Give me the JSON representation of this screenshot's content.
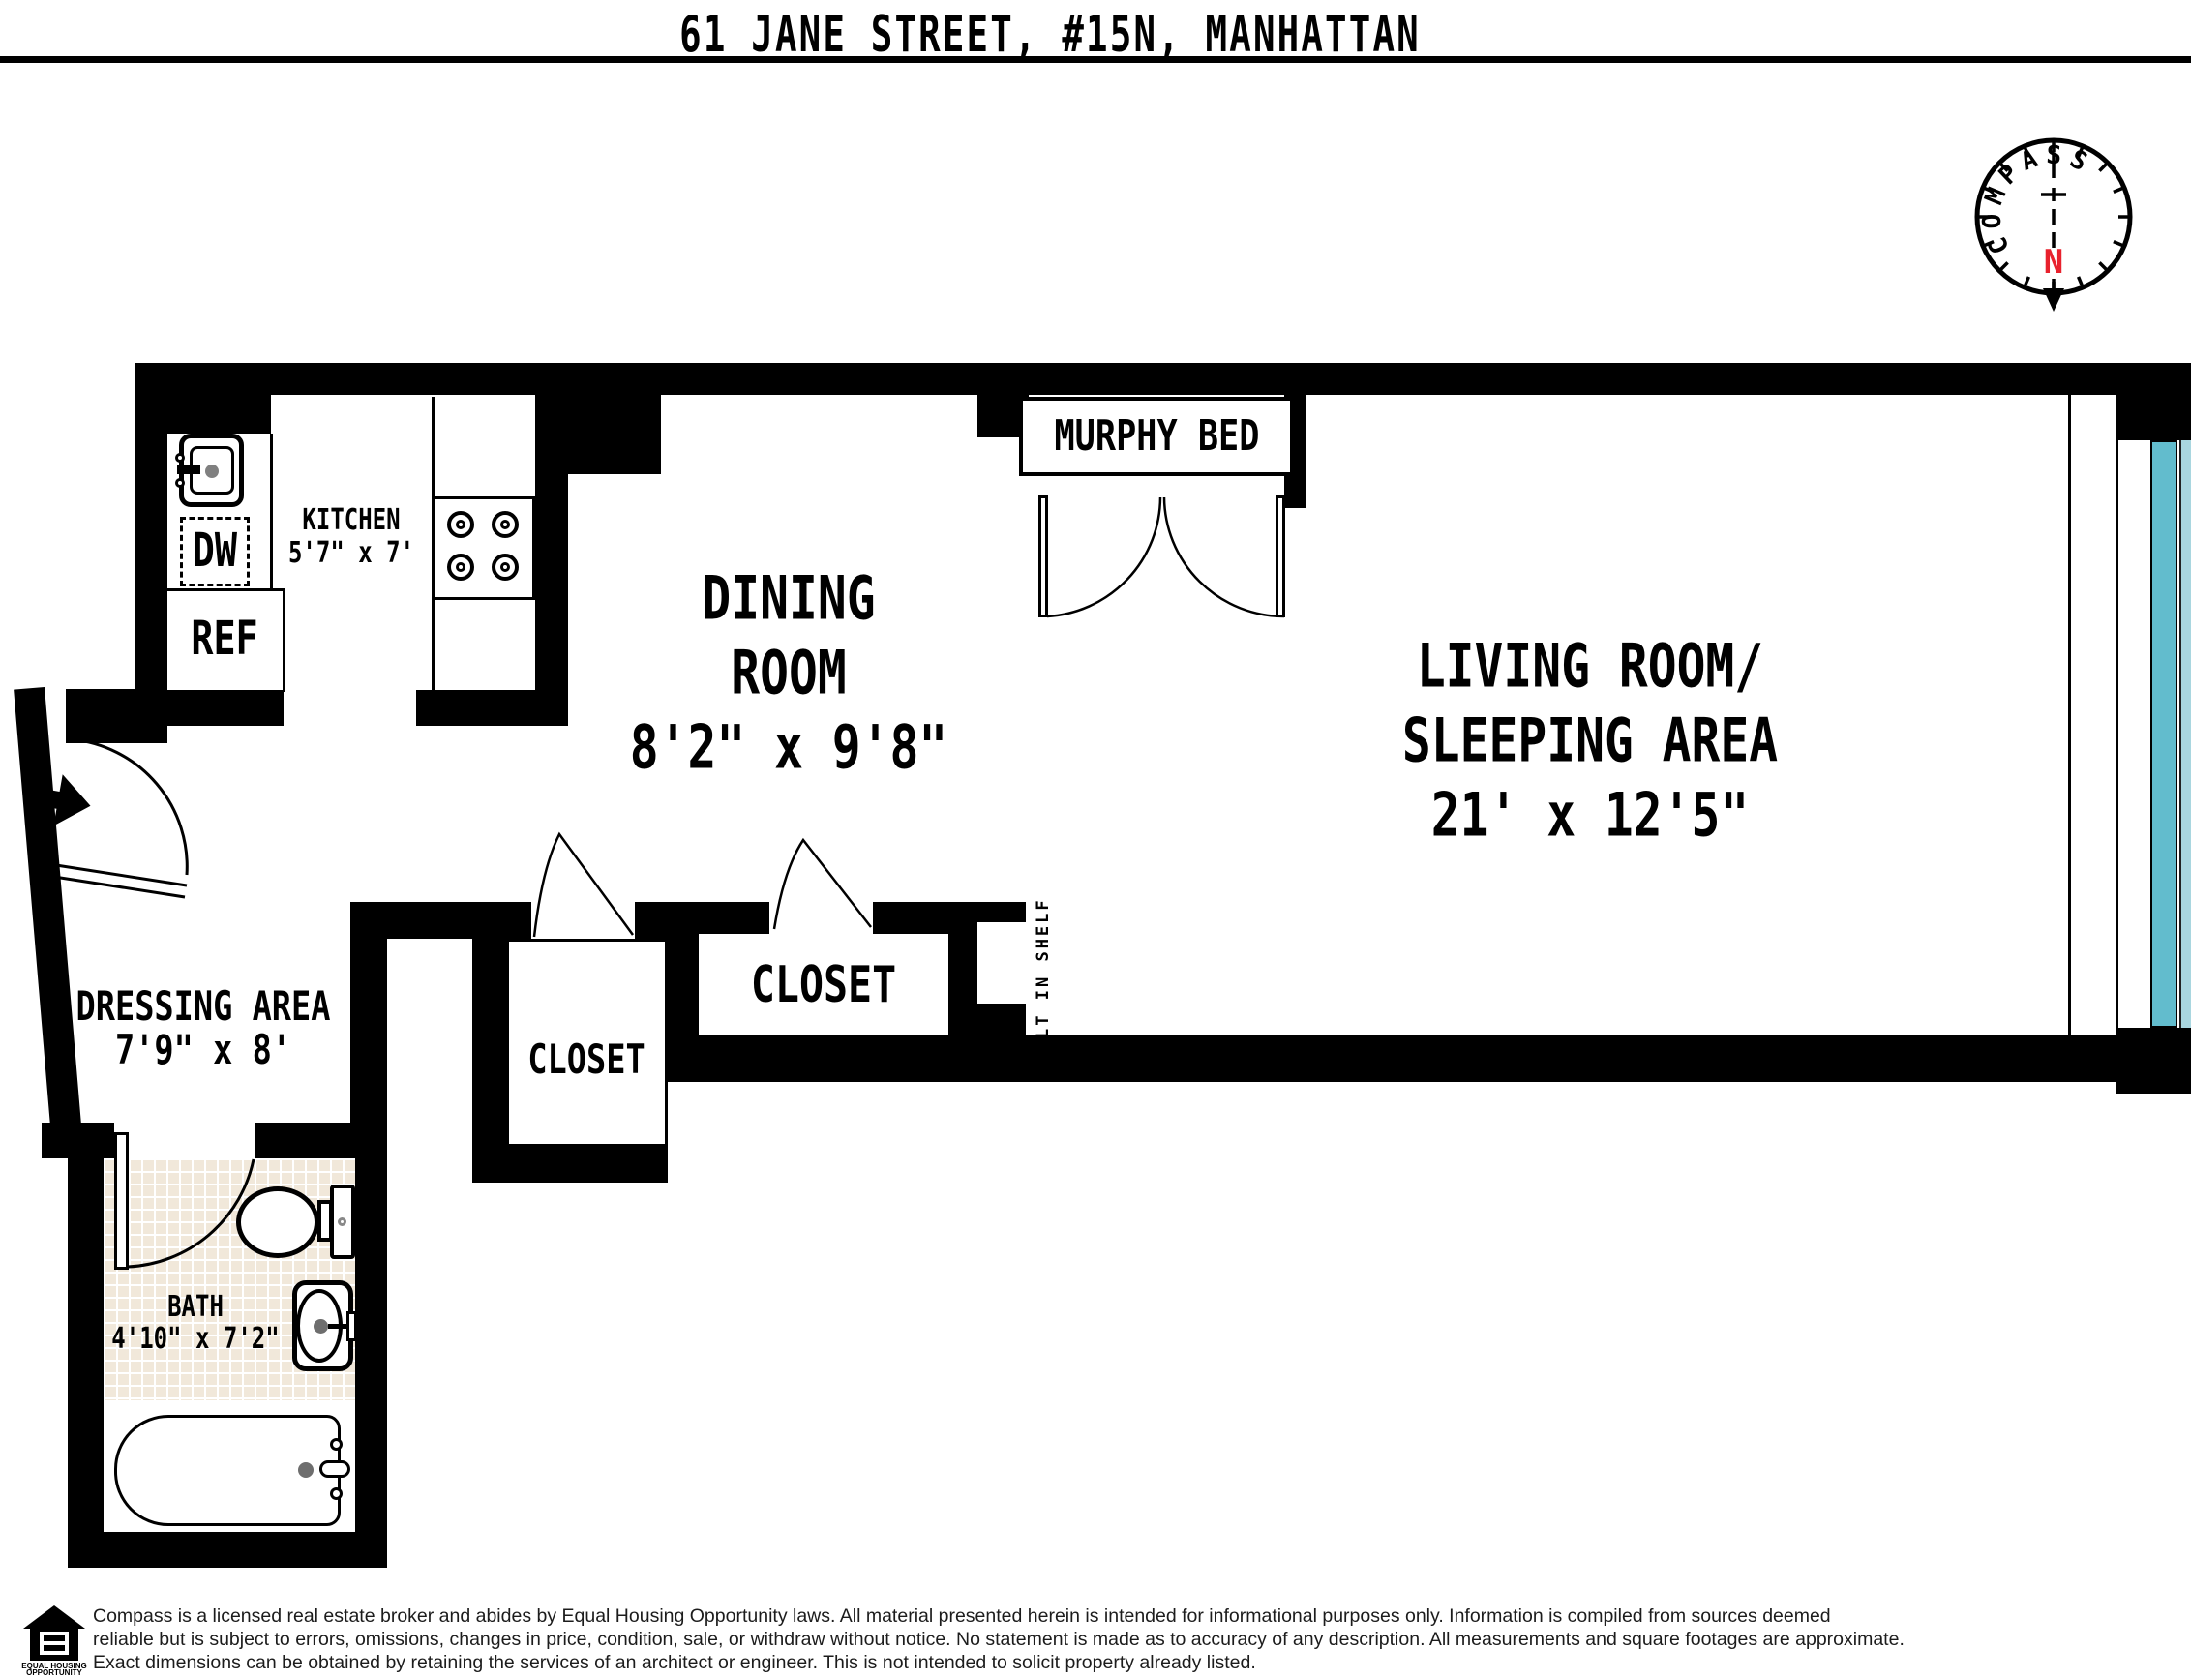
{
  "header": {
    "title": "61 JANE STREET, #15N, MANHATTAN"
  },
  "compass": {
    "label": "COMPASS",
    "north_label": "N",
    "north_color": "#e8212d"
  },
  "rooms": {
    "kitchen": {
      "name": "KITCHEN",
      "dims": "5'7\" x 7'"
    },
    "dining": {
      "line1": "DINING",
      "line2": "ROOM",
      "dims": "8'2\" x 9'8\""
    },
    "living": {
      "line1": "LIVING ROOM/",
      "line2": "SLEEPING AREA",
      "dims": "21' x 12'5\""
    },
    "dressing": {
      "name": "DRESSING AREA",
      "dims": "7'9\" x 8'"
    },
    "bath": {
      "name": "BATH",
      "dims": "4'10\" x 7'2\""
    },
    "murphy_bed": {
      "name": "MURPHY BED"
    },
    "closet_small": {
      "name": "CLOSET"
    },
    "closet_large": {
      "name": "CLOSET"
    },
    "built_in_shelf": {
      "name": "BUILT IN SHELF"
    }
  },
  "appliances": {
    "dishwasher": "DW",
    "refrigerator": "REF"
  },
  "colors": {
    "window_glass": "#62bccd",
    "window_glass_light": "#a9d6df",
    "bath_tile": "#f1e8da",
    "north_red": "#e8212d"
  },
  "footer": {
    "logo_line1": "EQUAL HOUSING",
    "logo_line2": "OPPORTUNITY",
    "line1": "Compass is a licensed real estate broker and abides by Equal Housing Opportunity laws. All material presented herein is intended for informational purposes only. Information is compiled from sources deemed",
    "line2": "reliable but is subject to errors, omissions, changes in price, condition, sale, or withdraw without notice. No statement is made as to accuracy of any description. All measurements and square footages are approximate.",
    "line3": "Exact dimensions can be obtained by retaining the services of an architect or engineer. This is not intended to solicit property already listed."
  }
}
